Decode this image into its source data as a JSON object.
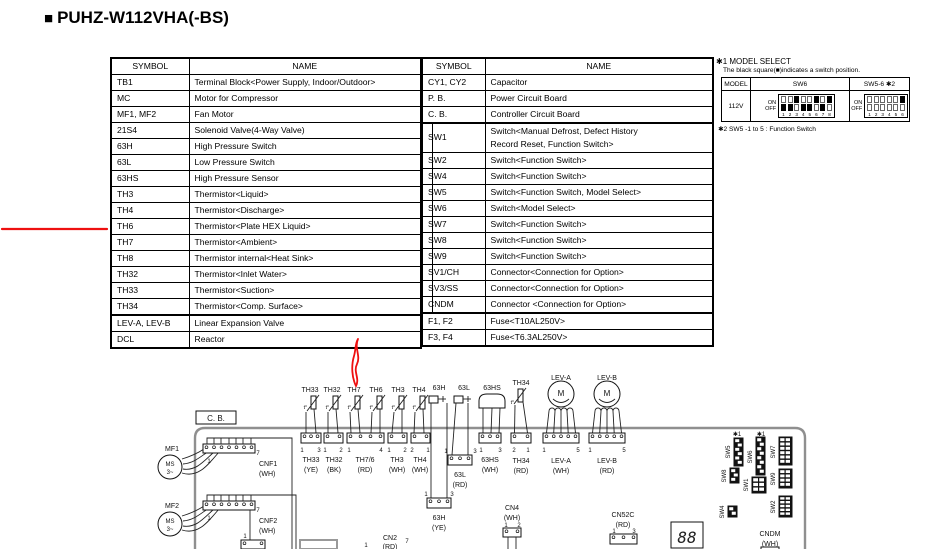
{
  "title_bullet": "■",
  "title": "PUHZ-W112VHA(-BS)",
  "left_table": {
    "col_symbol": "SYMBOL",
    "col_name": "NAME",
    "rows": [
      {
        "s": "TB1",
        "n": "Terminal Block<Power Supply, Indoor/Outdoor>"
      },
      {
        "s": "MC",
        "n": "Motor for Compressor"
      },
      {
        "s": "MF1, MF2",
        "n": "Fan Motor"
      },
      {
        "s": "21S4",
        "n": "Solenoid Valve(4-Way Valve)"
      },
      {
        "s": "63H",
        "n": "High Pressure Switch"
      },
      {
        "s": "63L",
        "n": "Low Pressure Switch"
      },
      {
        "s": "63HS",
        "n": "High Pressure Sensor"
      },
      {
        "s": "TH3",
        "n": "Thermistor<Liquid>"
      },
      {
        "s": "TH4",
        "n": "Thermistor<Discharge>"
      },
      {
        "s": "TH6",
        "n": "Thermistor<Plate HEX Liquid>"
      },
      {
        "s": "TH7",
        "n": "Thermistor<Ambient>"
      },
      {
        "s": "TH8",
        "n": "Thermistor internal<Heat Sink>"
      },
      {
        "s": "TH32",
        "n": "Thermistor<Inlet Water>"
      },
      {
        "s": "TH33",
        "n": "Thermistor<Suction>"
      },
      {
        "s": "TH34",
        "n": "Thermistor<Comp. Surface>"
      },
      {
        "s": "LEV-A, LEV-B",
        "n": "Linear Expansion Valve",
        "thick": true
      },
      {
        "s": "DCL",
        "n": "Reactor"
      }
    ]
  },
  "right_table": {
    "col_symbol": "SYMBOL",
    "col_name": "NAME",
    "rows": [
      {
        "s": "CY1, CY2",
        "n": "Capacitor"
      },
      {
        "s": "P. B.",
        "n": "Power Circuit Board"
      },
      {
        "s": "C. B.",
        "n": "Controller Circuit Board"
      },
      {
        "s": "SW1",
        "n": "Switch<Manual Defrost, Defect History",
        "n2": "Record Reset, Function Switch>",
        "sub": true,
        "thick": true
      },
      {
        "s": "SW2",
        "n": "Switch<Function Switch>",
        "sub": true
      },
      {
        "s": "SW4",
        "n": "Switch<Function Switch>",
        "sub": true
      },
      {
        "s": "SW5",
        "n": "Switch<Function Switch, Model Select>",
        "sub": true
      },
      {
        "s": "SW6",
        "n": "Switch<Model Select>",
        "sub": true
      },
      {
        "s": "SW7",
        "n": "Switch<Function Switch>",
        "sub": true
      },
      {
        "s": "SW8",
        "n": "Switch<Function Switch>",
        "sub": true
      },
      {
        "s": "SW9",
        "n": "Switch<Function Switch>",
        "sub": true
      },
      {
        "s": "SV1/CH",
        "n": "Connector<Connection for Option>",
        "sub": true
      },
      {
        "s": "SV3/SS",
        "n": "Connector<Connection for Option>",
        "sub": true
      },
      {
        "s": "CNDM",
        "n": "Connector <Connection for Option>",
        "sub": true
      },
      {
        "s": "F1, F2",
        "n": "Fuse<T10AL250V>",
        "thick": true
      },
      {
        "s": "F3, F4",
        "n": "Fuse<T6.3AL250V>"
      }
    ]
  },
  "model_select": {
    "heading": "✱1 MODEL SELECT",
    "subnote": "The black square(■)indicates a switch position.",
    "col_model": "MODEL",
    "col_sw6": "SW6",
    "col_sw56": "SW5-6 ✱2",
    "model": "112V",
    "on": "ON",
    "off": "OFF",
    "sw6_pattern": [
      "off",
      "off",
      "on",
      "off",
      "off",
      "on",
      "off",
      "on"
    ],
    "sw6_numbers": [
      "1",
      "2",
      "3",
      "4",
      "5",
      "6",
      "7",
      "8"
    ],
    "sw56_pattern": [
      "none",
      "none",
      "none",
      "none",
      "none",
      "on"
    ],
    "sw56_numbers": [
      "1",
      "2",
      "3",
      "4",
      "5",
      "6"
    ],
    "footnote": "✱2 SW5 -1 to 5 : Function Switch"
  },
  "annotations": {
    "color": "#ee1010"
  },
  "diagram": {
    "cb_label": "C. B.",
    "fan1": {
      "name": "MF1",
      "motor": "MS",
      "phase": "3~",
      "p1": "1",
      "p2": "7",
      "conn": "CNF1",
      "color": "(WH)"
    },
    "fan2": {
      "name": "MF2",
      "motor": "MS",
      "phase": "3~",
      "p1": "1",
      "p2": "7",
      "conn": "CNF2",
      "color": "(WH)"
    },
    "th_symbol": "t°",
    "th_labels": [
      "TH33",
      "TH32",
      "TH7",
      "TH6",
      "TH3",
      "TH4"
    ],
    "th_conns": [
      {
        "name": "TH33",
        "color": "(YE)",
        "pl": "1",
        "pr": "3"
      },
      {
        "name": "TH32",
        "color": "(BK)",
        "pl": "1",
        "pr": "2"
      },
      {
        "name": "TH7/6",
        "color": "(RD)",
        "pl": "1",
        "pr": "4"
      },
      {
        "name": "TH3",
        "color": "(WH)",
        "pl": "1",
        "pr": "2"
      },
      {
        "name": "TH4",
        "color": "(WH)",
        "pl": "2",
        "pr": "1"
      }
    ],
    "p63h": "63H",
    "p63l": "63L",
    "p63hs": "63HS",
    "c63hs": {
      "name": "63HS",
      "color": "(WH)",
      "pl": "1",
      "pr": "3"
    },
    "c63l": {
      "name": "63L",
      "color": "(RD)",
      "pl": "1",
      "pr": "3"
    },
    "c63h": {
      "name": "63H",
      "color": "(YE)",
      "pl": "1",
      "pr": "3"
    },
    "th34": {
      "top": "TH34",
      "name": "TH34",
      "color": "(RD)",
      "pl": "2",
      "pr": "1"
    },
    "leva": {
      "top": "LEV-A",
      "m": "M",
      "name": "LEV-A",
      "color": "(WH)",
      "pl": "1",
      "pr": "5"
    },
    "levb": {
      "top": "LEV-B",
      "m": "M",
      "name": "LEV-B",
      "color": "(RD)",
      "pl": "1",
      "pr": "5"
    },
    "cn4": {
      "name": "CN4",
      "color": "(WH)",
      "pl": "1",
      "pr": "2"
    },
    "cn52c": {
      "name": "CN52C",
      "color": "(RD)",
      "pl": "1",
      "pr": "3"
    },
    "cn2": {
      "name": "CN2",
      "color": "(RD)",
      "pl": "1",
      "pr": "7"
    },
    "cndm": {
      "name": "CNDM",
      "color": "(WH)"
    },
    "display": "88",
    "star1": "✱1",
    "pin1": "1",
    "sw": {
      "sw5": "SW5",
      "sw8": "SW8",
      "sw6": "SW6",
      "sw1": "SW1",
      "sw4": "SW4",
      "sw7": "SW7",
      "sw9": "SW9",
      "sw2": "SW2"
    }
  }
}
